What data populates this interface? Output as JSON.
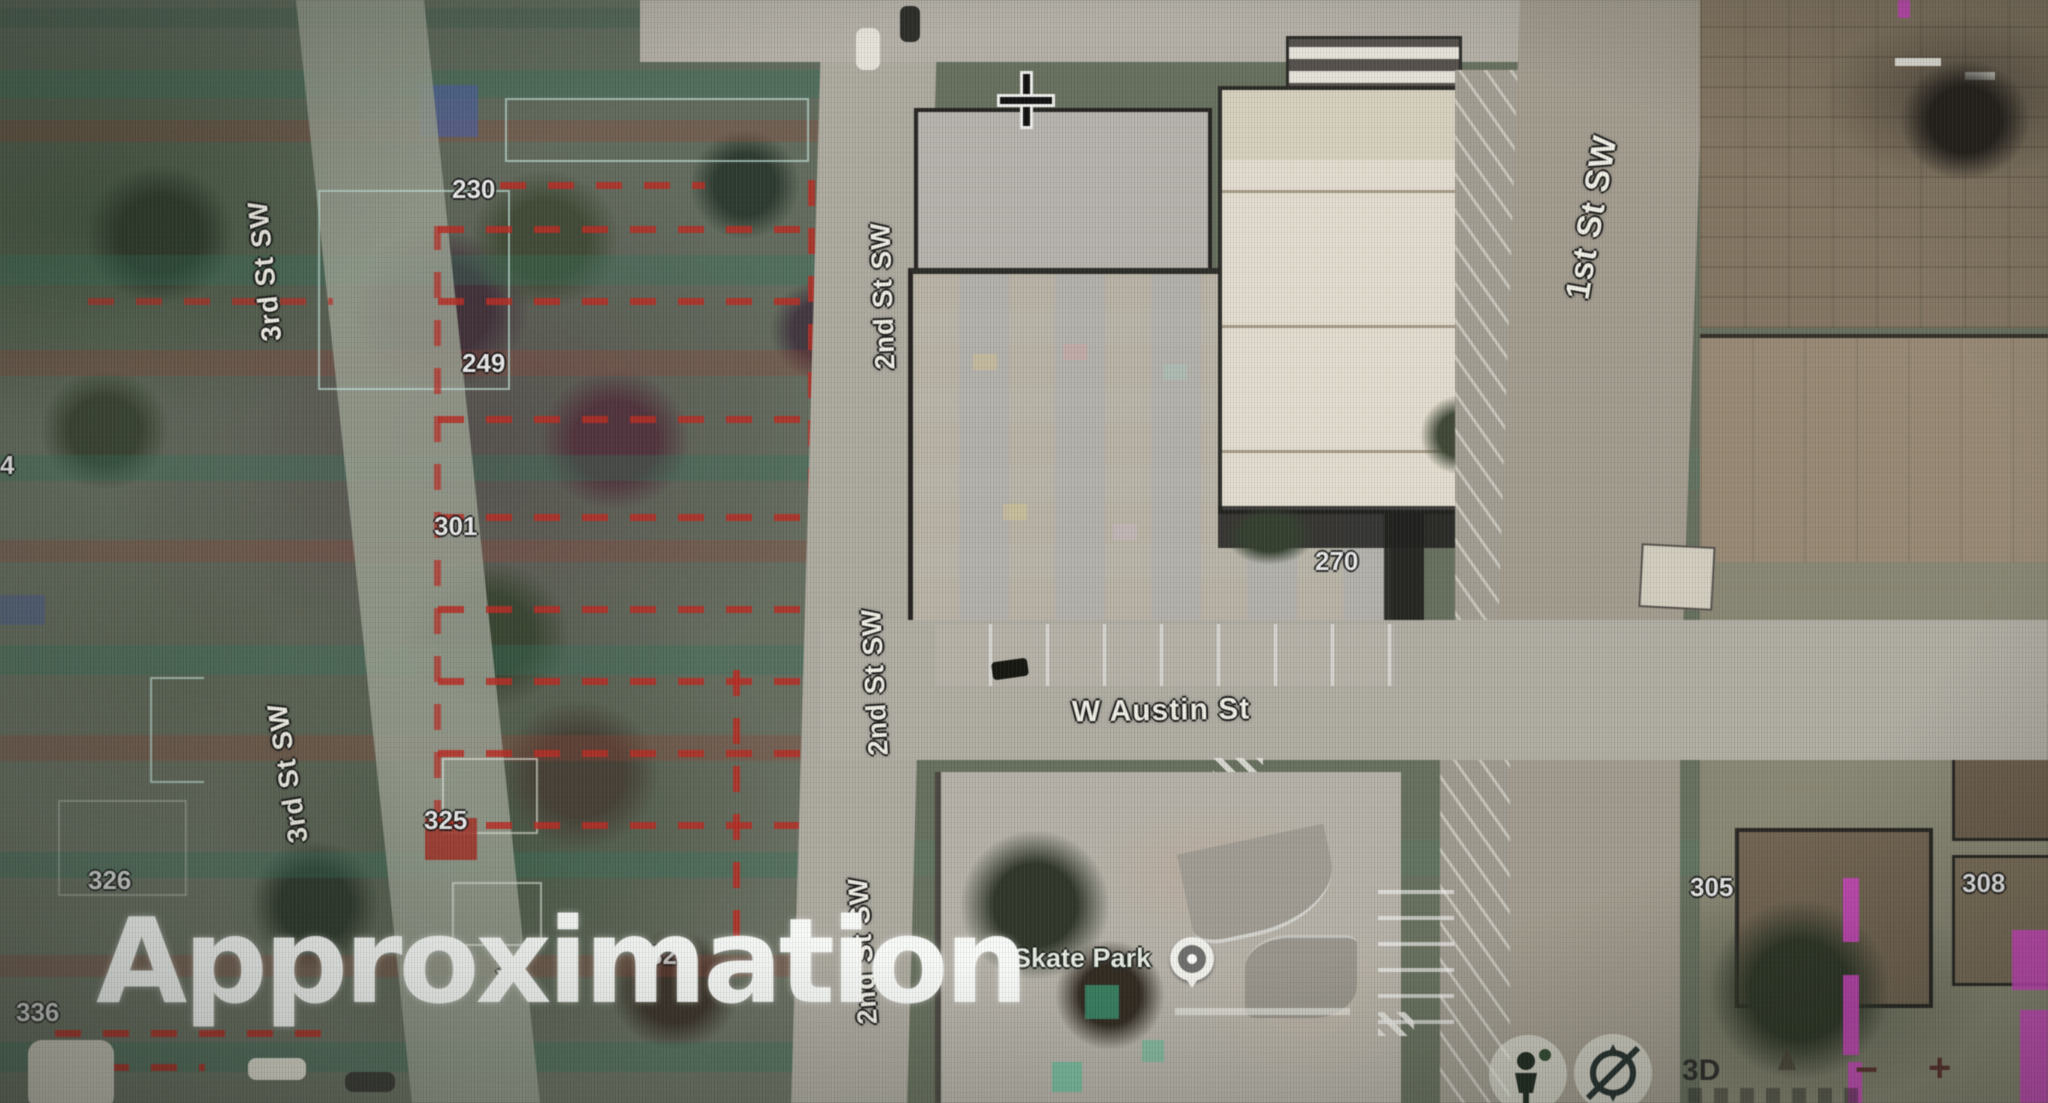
{
  "watermark": "Approximation",
  "streets": {
    "third_a": "3rd St SW",
    "third_b": "3rd St SW",
    "second_a": "2nd St SW",
    "second_b": "2nd St SW",
    "second_c": "2nd St SW",
    "first_a": "1st St SW",
    "austin": "W Austin St"
  },
  "poi": {
    "skate_park": "Skate Park"
  },
  "parcels": {
    "p4": "4",
    "p230": "230",
    "p249": "249",
    "p301": "301",
    "p322": "322",
    "p325": "325",
    "p326": "326",
    "p33": "33",
    "p336": "336",
    "p270": "270",
    "p305": "305",
    "p308": "308"
  },
  "controls": {
    "mode_3d": "3D",
    "zoom_out": "−",
    "zoom_in": "+"
  },
  "icons": [
    "pegman-icon",
    "compass-icon",
    "cone-icon",
    "skate-park-poi-icon",
    "crosshair-icon"
  ],
  "colors": {
    "parcel_line_red": "#c8281e",
    "boundary_teal": "#bee2d8",
    "glitch_magenta": "#e33fd4",
    "glitch_green": "#2ec98f",
    "label_white": "#f3f1e7",
    "zoom_glyph_brown": "#5e2f2a"
  }
}
